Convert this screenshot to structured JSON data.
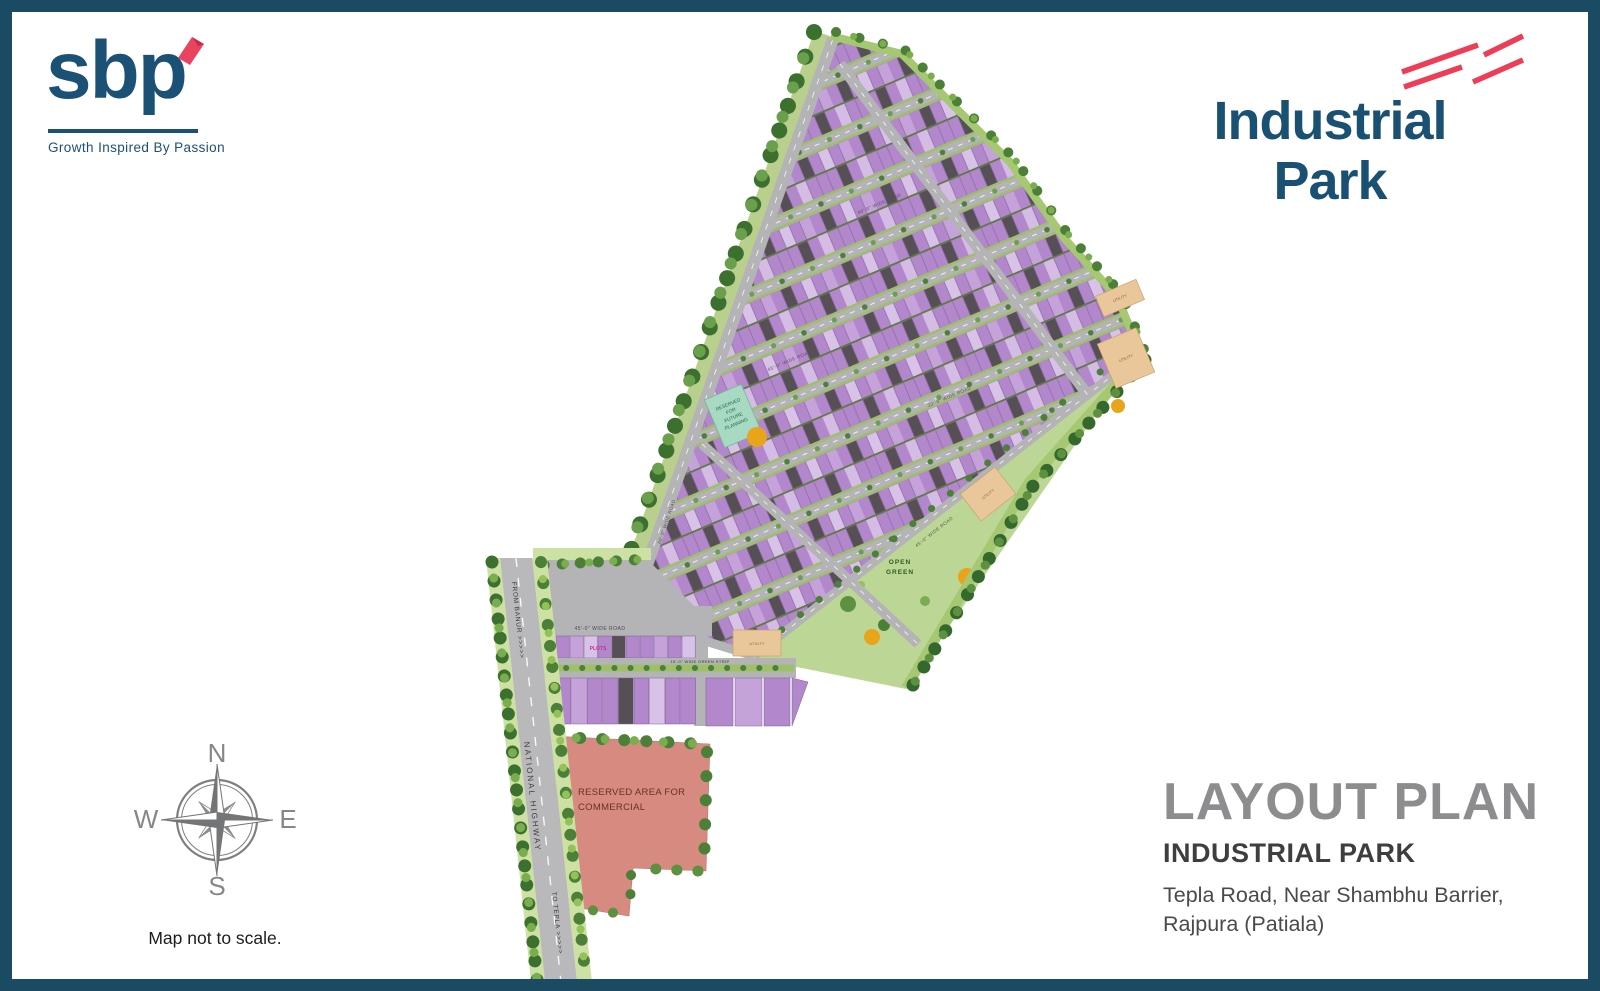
{
  "brand": {
    "logo": "sbp",
    "tagline": "Growth Inspired By Passion"
  },
  "product": {
    "line1": "Industrial",
    "line2": "Park"
  },
  "compass": {
    "north": "N",
    "south": "S",
    "east": "E",
    "west": "W",
    "note": "Map not to scale."
  },
  "title_block": {
    "title": "LAYOUT PLAN",
    "subtitle": "INDUSTRIAL PARK",
    "address": [
      "Tepla Road, Near Shambhu Barrier,",
      "Rajpura (Patiala)"
    ]
  },
  "map": {
    "areas": {
      "future_planning": [
        "RESERVED",
        "FOR",
        "FUTURE",
        "PLANNING"
      ],
      "utility": "UTILITY",
      "open_green": [
        "OPEN",
        "GREEN"
      ],
      "commercial": [
        "RESERVED AREA FOR",
        "COMMERCIAL"
      ],
      "plots": "PLOTS"
    },
    "roads": {
      "national_highway": "NATIONAL HIGHWAY",
      "from_banur": "FROM BANUR >>>>>",
      "to_tepla": "TO TEPLA >>>>>",
      "road_60": "60'-0\" WIDE ROAD",
      "road_45": "45'-0\" WIDE ROAD",
      "road_33": "33'-0\" WIDE ROAD",
      "green_strip": "15'-0\" WIDE GREEN STRIP"
    },
    "colors": {
      "border_navy": "#1b4a63",
      "brand_navy": "#1b5174",
      "accent_red": "#ee3e57",
      "plot_purple": "#b287cb",
      "plot_light": "#d8c2e7",
      "road_gray": "#b4b3b5",
      "green_strip": "#9dc069",
      "open_green": "#bcd795",
      "commercial_salmon": "#d78b80",
      "utility_tan": "#eac79b",
      "future_teal": "#a8d9c2",
      "tree_green": "#4c7f38",
      "tree_orange": "#e8a41b",
      "title_gray": "#8d8d90"
    }
  }
}
